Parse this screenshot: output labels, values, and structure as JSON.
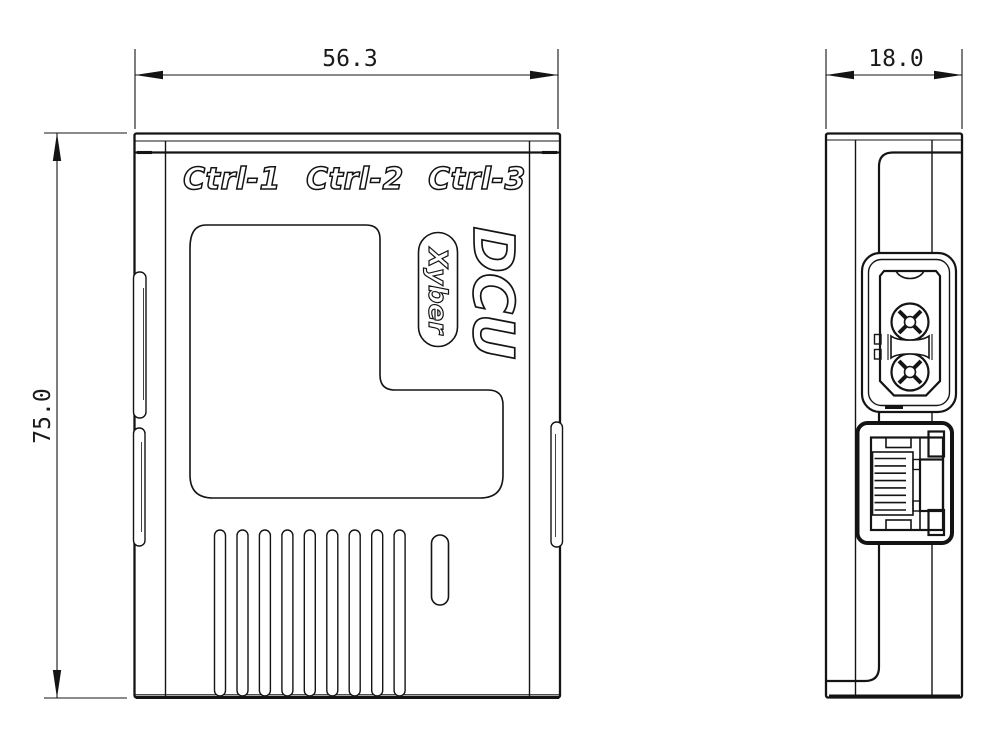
{
  "drawing": {
    "port_labels": [
      "Ctrl-1",
      "Ctrl-2",
      "Ctrl-3"
    ],
    "product_name": "DCU",
    "brand": "Xyber",
    "dims": {
      "width": "56.3",
      "height": "75.0",
      "depth": "18.0"
    },
    "colors": {
      "line": "#141414",
      "background": "#ffffff"
    }
  }
}
